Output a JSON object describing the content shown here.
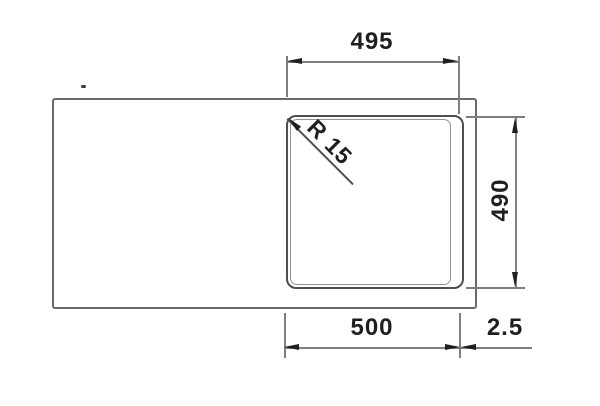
{
  "drawing": {
    "title": "sink-dimension-drawing",
    "dimensions": {
      "top_width": "495",
      "right_height": "490",
      "bottom_width": "500",
      "edge_offset": "2.5",
      "corner_radius": "R 15"
    },
    "colors": {
      "background": "#ffffff",
      "outline": "#6a6a6a",
      "bowl_outline": "#4f4f4f",
      "bowl_inner_line": "#929292",
      "dim_line": "#7e7e7e",
      "text": "#1f1f1f"
    }
  }
}
